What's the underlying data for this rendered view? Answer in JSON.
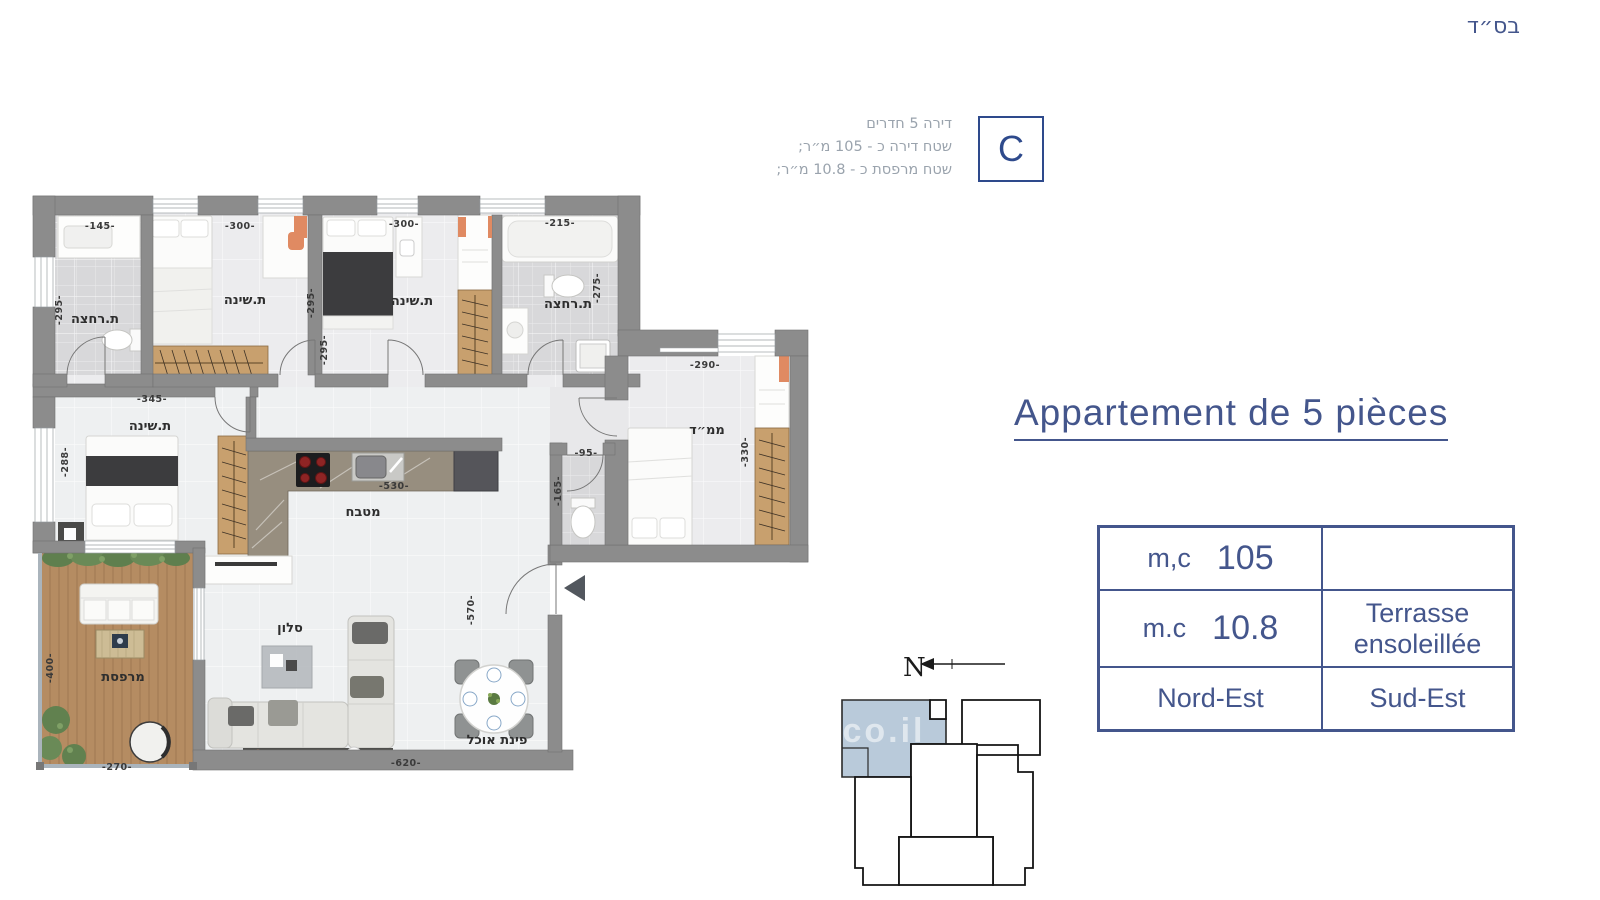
{
  "meta": {
    "bsd": "בס״ד"
  },
  "header": {
    "unit_letter": "C",
    "info_lines": [
      "דירה 5 חדרים",
      "שטח דירה כ - 105 מ״ר;",
      "שטח מרפסת כ - 10.8 מ״ר;"
    ]
  },
  "title": {
    "text": "Appartement de 5 pièces"
  },
  "table": {
    "r1": {
      "label": "m,c",
      "value": "105",
      "right": ""
    },
    "r2": {
      "label": "m.c",
      "value": "10.8",
      "right": "Terrasse ensoleillée"
    },
    "r3": {
      "left": "Nord-Est",
      "right": "Sud-Est"
    }
  },
  "compass": {
    "north_label": "N"
  },
  "watermark": {
    "text": ".co.il"
  },
  "colors": {
    "accent": "#44568c",
    "accent_dark": "#2e4a8c",
    "muted_text": "#9aa3ad",
    "wall": "#8c8c8c",
    "floor": "#ececee",
    "bath_tile": "#d8d8da",
    "wood": "#c8a06e",
    "deck": "#b58c62",
    "highlight": "#b9cada",
    "label": "#2e2e2e"
  },
  "plan": {
    "rooms": [
      {
        "text": "ת.רחצה",
        "x": 95,
        "y": 323,
        "rot": 0
      },
      {
        "text": "ת.שינה",
        "x": 245,
        "y": 304,
        "rot": 0
      },
      {
        "text": "ת.שינה",
        "x": 412,
        "y": 305,
        "rot": 0
      },
      {
        "text": "ת.רחצה",
        "x": 568,
        "y": 308,
        "rot": 0
      },
      {
        "text": "ת.שינה",
        "x": 150,
        "y": 430,
        "rot": 0
      },
      {
        "text": "ממ״ד",
        "x": 707,
        "y": 434,
        "rot": 0
      },
      {
        "text": "מטבח",
        "x": 363,
        "y": 516,
        "rot": 0
      },
      {
        "text": "סלון",
        "x": 290,
        "y": 632,
        "rot": 0
      },
      {
        "text": "פינת אוכל",
        "x": 497,
        "y": 744,
        "rot": 0
      },
      {
        "text": "מרפסת",
        "x": 123,
        "y": 681,
        "rot": 0
      }
    ],
    "dimensions": [
      {
        "text": "-145-",
        "x": 100,
        "y": 229,
        "rot": 0
      },
      {
        "text": "-295-",
        "x": 62,
        "y": 310,
        "rot": -90
      },
      {
        "text": "-300-",
        "x": 240,
        "y": 229,
        "rot": 0
      },
      {
        "text": "-295-",
        "x": 314,
        "y": 303,
        "rot": -90
      },
      {
        "text": "-295-",
        "x": 327,
        "y": 350,
        "rot": -90
      },
      {
        "text": "-300-",
        "x": 404,
        "y": 227,
        "rot": 0
      },
      {
        "text": "-215-",
        "x": 560,
        "y": 226,
        "rot": 0
      },
      {
        "text": "-275-",
        "x": 600,
        "y": 288,
        "rot": -90
      },
      {
        "text": "-345-",
        "x": 152,
        "y": 402,
        "rot": 0
      },
      {
        "text": "-288-",
        "x": 68,
        "y": 462,
        "rot": -90
      },
      {
        "text": "-530-",
        "x": 394,
        "y": 489,
        "rot": 0
      },
      {
        "text": "-95-",
        "x": 586,
        "y": 456,
        "rot": 0
      },
      {
        "text": "-165-",
        "x": 561,
        "y": 491,
        "rot": -90
      },
      {
        "text": "-290-",
        "x": 705,
        "y": 368,
        "rot": 0
      },
      {
        "text": "-330-",
        "x": 748,
        "y": 452,
        "rot": -90
      },
      {
        "text": "-570-",
        "x": 474,
        "y": 610,
        "rot": -90
      },
      {
        "text": "-620-",
        "x": 406,
        "y": 766,
        "rot": 0
      },
      {
        "text": "-400-",
        "x": 53,
        "y": 668,
        "rot": -90
      },
      {
        "text": "-270-",
        "x": 117,
        "y": 770,
        "rot": 0
      }
    ]
  }
}
